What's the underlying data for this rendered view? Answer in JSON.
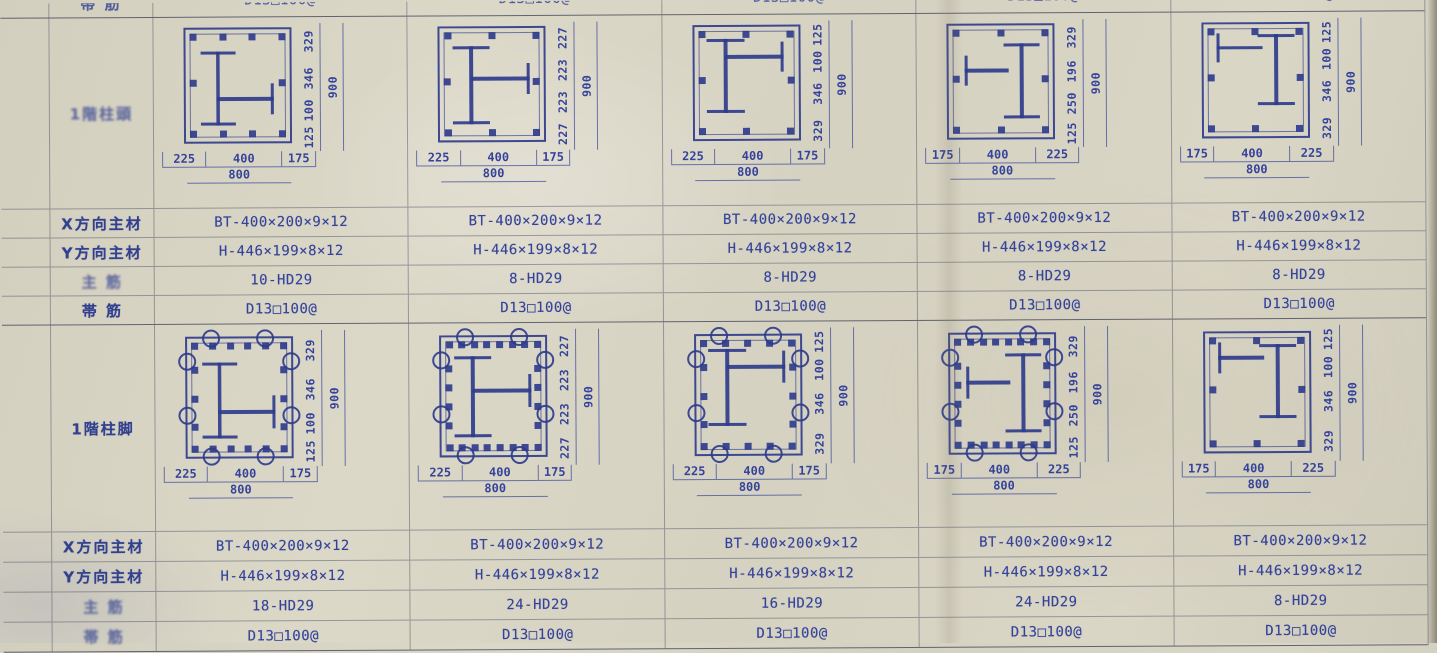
{
  "paper": {
    "background": "#d8d4c4",
    "ink": "#35439a",
    "grid_line": "#50556a"
  },
  "row_labels": {
    "x_dir": "X方向主材",
    "y_dir": "Y方向主材",
    "main": "主 筋",
    "hoop": "帯 筋"
  },
  "partial_top": {
    "label": "帯 筋",
    "value": "D13□100@"
  },
  "sections": [
    {
      "name": "1階柱頭",
      "columns": [
        {
          "x_member": "BT-400×200×9×12",
          "y_member": "H-446×199×8×12",
          "main_bars": "10-HD29",
          "hoops": "D13□100@",
          "dims_right": [
            "329",
            "346",
            "100",
            "125"
          ],
          "dim_total_v": "900",
          "dims_bottom": [
            "225",
            "400",
            "175"
          ],
          "dim_total_h": "800",
          "variant": "v1",
          "hooks": false
        },
        {
          "x_member": "BT-400×200×9×12",
          "y_member": "H-446×199×8×12",
          "main_bars": "8-HD29",
          "hoops": "D13□100@",
          "dims_right": [
            "227",
            "223",
            "223",
            "227"
          ],
          "dim_total_v": "900",
          "dims_bottom": [
            "225",
            "400",
            "175"
          ],
          "dim_total_h": "800",
          "variant": "v2",
          "hooks": false
        },
        {
          "x_member": "BT-400×200×9×12",
          "y_member": "H-446×199×8×12",
          "main_bars": "8-HD29",
          "hoops": "D13□100@",
          "dims_right": [
            "125",
            "100",
            "346",
            "329"
          ],
          "dim_total_v": "900",
          "dims_bottom": [
            "225",
            "400",
            "175"
          ],
          "dim_total_h": "800",
          "variant": "v3",
          "hooks": false
        },
        {
          "x_member": "BT-400×200×9×12",
          "y_member": "H-446×199×8×12",
          "main_bars": "8-HD29",
          "hoops": "D13□100@",
          "dims_right": [
            "329",
            "196",
            "250",
            "125"
          ],
          "dim_total_v": "900",
          "dims_bottom": [
            "175",
            "400",
            "225"
          ],
          "dim_total_h": "800",
          "variant": "v4",
          "hooks": false
        },
        {
          "x_member": "BT-400×200×9×12",
          "y_member": "H-446×199×8×12",
          "main_bars": "8-HD29",
          "hoops": "D13□100@",
          "dims_right": [
            "125",
            "100",
            "346",
            "329"
          ],
          "dim_total_v": "900",
          "dims_bottom": [
            "175",
            "400",
            "225"
          ],
          "dim_total_h": "800",
          "variant": "v5",
          "hooks": false
        }
      ]
    },
    {
      "name": "1階柱脚",
      "columns": [
        {
          "x_member": "BT-400×200×9×12",
          "y_member": "H-446×199×8×12",
          "main_bars": "18-HD29",
          "hoops": "D13□100@",
          "dims_right": [
            "329",
            "346",
            "100",
            "125"
          ],
          "dim_total_v": "900",
          "dims_bottom": [
            "225",
            "400",
            "175"
          ],
          "dim_total_h": "800",
          "variant": "v1",
          "hooks": true
        },
        {
          "x_member": "BT-400×200×9×12",
          "y_member": "H-446×199×8×12",
          "main_bars": "24-HD29",
          "hoops": "D13□100@",
          "dims_right": [
            "227",
            "223",
            "223",
            "227"
          ],
          "dim_total_v": "900",
          "dims_bottom": [
            "225",
            "400",
            "175"
          ],
          "dim_total_h": "800",
          "variant": "v2",
          "hooks": true
        },
        {
          "x_member": "BT-400×200×9×12",
          "y_member": "H-446×199×8×12",
          "main_bars": "16-HD29",
          "hoops": "D13□100@",
          "dims_right": [
            "125",
            "100",
            "346",
            "329"
          ],
          "dim_total_v": "900",
          "dims_bottom": [
            "225",
            "400",
            "175"
          ],
          "dim_total_h": "800",
          "variant": "v3",
          "hooks": true
        },
        {
          "x_member": "BT-400×200×9×12",
          "y_member": "H-446×199×8×12",
          "main_bars": "24-HD29",
          "hoops": "D13□100@",
          "dims_right": [
            "329",
            "196",
            "250",
            "125"
          ],
          "dim_total_v": "900",
          "dims_bottom": [
            "175",
            "400",
            "225"
          ],
          "dim_total_h": "800",
          "variant": "v4",
          "hooks": true
        },
        {
          "x_member": "BT-400×200×9×12",
          "y_member": "H-446×199×8×12",
          "main_bars": "8-HD29",
          "hoops": "D13□100@",
          "dims_right": [
            "125",
            "100",
            "346",
            "329"
          ],
          "dim_total_v": "900",
          "dims_bottom": [
            "175",
            "400",
            "225"
          ],
          "dim_total_h": "800",
          "variant": "v5",
          "hooks": false
        }
      ]
    }
  ]
}
